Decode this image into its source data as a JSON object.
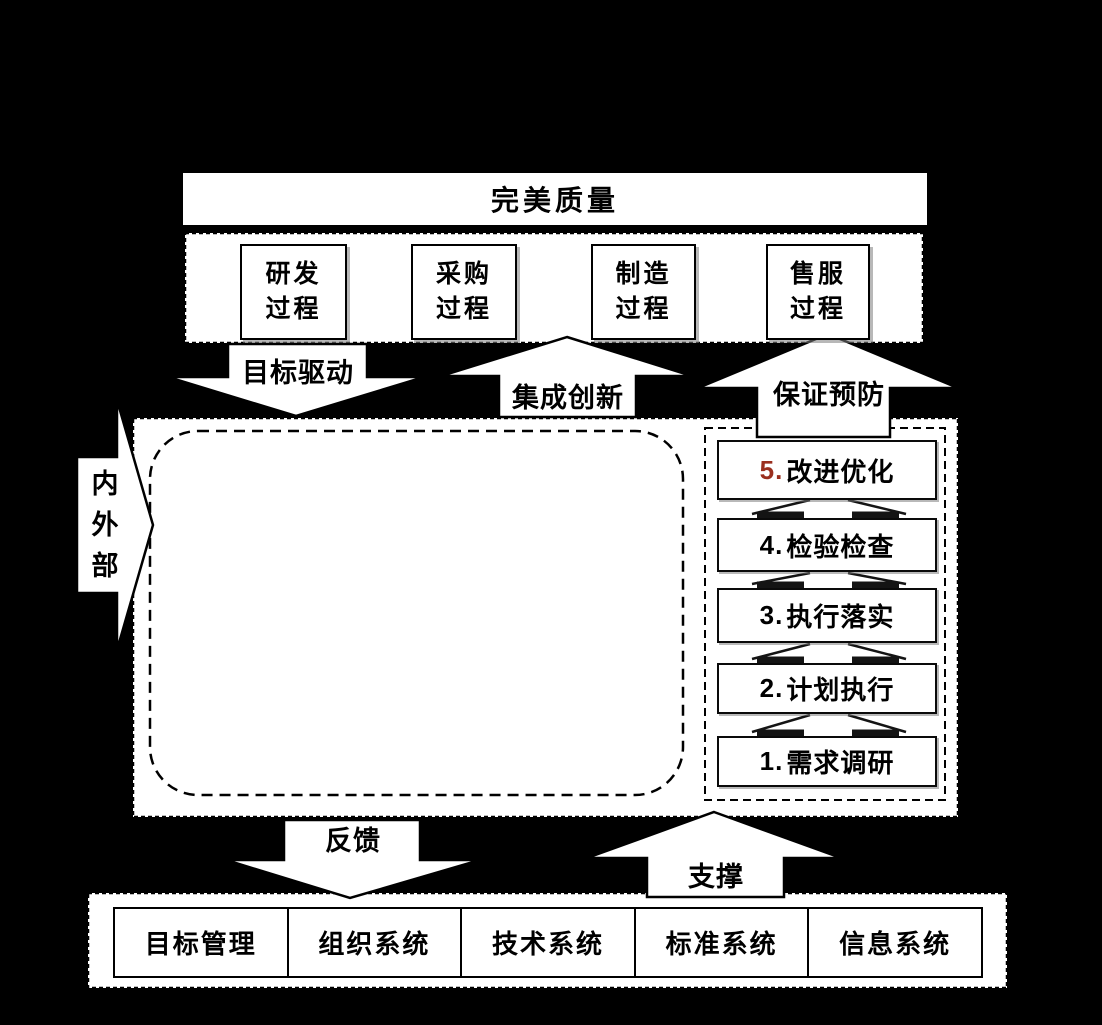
{
  "colors": {
    "background": "#000000",
    "surface": "#ffffff",
    "line": "#000000",
    "step5_number": "#9a2f1f"
  },
  "top": {
    "quality_box": "完美质量",
    "process_boxes": [
      "研发\n过程",
      "采购\n过程",
      "制造\n过程",
      "售服\n过程"
    ]
  },
  "arrows": {
    "goal_driven": "目标驱动",
    "integration": "集成创新",
    "prevention": "保证预防",
    "internal_external": "内外部",
    "feedback": "反馈",
    "support": "支撑"
  },
  "steps": [
    {
      "number": "5.",
      "label": "改进优化",
      "number_color": "#9a2f1f"
    },
    {
      "number": "4.",
      "label": "检验检查",
      "number_color": "#000000"
    },
    {
      "number": "3.",
      "label": "执行落实",
      "number_color": "#000000"
    },
    {
      "number": "2.",
      "label": "计划执行",
      "number_color": "#000000"
    },
    {
      "number": "1.",
      "label": "需求调研",
      "number_color": "#000000"
    }
  ],
  "foundation": [
    "目标管理",
    "组织系统",
    "技术系统",
    "标准系统",
    "信息系统"
  ]
}
